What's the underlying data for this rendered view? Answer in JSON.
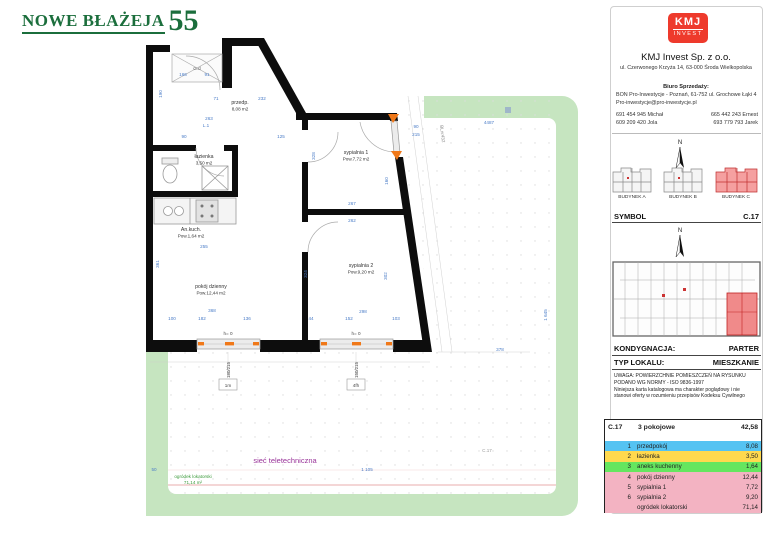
{
  "title": {
    "project": "NOWE BŁAŻEJA",
    "number": "55"
  },
  "company": {
    "logo_line1": "KMJ",
    "logo_line2": "INVEST",
    "name": "KMJ Invest Sp. z o.o.",
    "address": "ul. Czerwonego Krzyża 14, 63-000 Środa Wielkopolska",
    "sales_office_label": "Biuro Sprzedaży:",
    "sales_office_line1": "BON Pro-Inwestycje - Poznań, 61-752 ul. Grochowe Łąki 4",
    "sales_office_line2": "Pro-inwestycje@pro-inwestycje.pl",
    "phones_left": [
      "691 454 945 Michał",
      "609 209 420 Jola"
    ],
    "phones_right": [
      "665 442 243 Ernest",
      "693 779 793 Jarek"
    ]
  },
  "compass": "N",
  "buildings": [
    {
      "label": "BUDYNEK A",
      "highlighted": false
    },
    {
      "label": "BUDYNEK B",
      "highlighted": false
    },
    {
      "label": "BUDYNEK C",
      "highlighted": true
    }
  ],
  "symbol": {
    "label": "SYMBOL",
    "value": "C.17"
  },
  "floor": {
    "label": "KONDYGNACJA:",
    "value": "PARTER"
  },
  "unit_type": {
    "label": "TYP LOKALU:",
    "value": "MIESZKANIE"
  },
  "notice": {
    "lines": [
      "UWAGA: POWIERZCHNIE POMIESZCZEŃ NA RYSUNKU",
      "PODANO WG NORMY - ISO 9836-1997",
      "Niniejsza karta katalogowa ma charakter poglądowy i nie",
      "stanowi oferty w rozumieniu przepisów Kodeksu Cywilnego"
    ]
  },
  "table": {
    "symbol": "C.17",
    "type": "3 pokojowe",
    "total": "42,58",
    "rows": [
      {
        "num": "1",
        "name": "przedpokój",
        "area": "8,08",
        "color": "#55c3f2"
      },
      {
        "num": "2",
        "name": "łazienka",
        "area": "3,50",
        "color": "#ffd94e"
      },
      {
        "num": "3",
        "name": "aneks kuchenny",
        "area": "1,64",
        "color": "#65e65f"
      },
      {
        "num": "4",
        "name": "pokój dzienny",
        "area": "12,44",
        "color": "#f3b3c2"
      },
      {
        "num": "5",
        "name": "sypialnia 1",
        "area": "7,72",
        "color": "#f3b3c2"
      },
      {
        "num": "6",
        "name": "sypialnia 2",
        "area": "9,20",
        "color": "#f3b3c2"
      },
      {
        "num": "",
        "name": "ogródek lokatorski",
        "area": "71,14",
        "color": "#f3b3c2"
      }
    ]
  },
  "plan": {
    "rooms": [
      {
        "name": "przedp.",
        "area": "8,08 m2",
        "x": 240,
        "y": 104
      },
      {
        "name": "łazienka",
        "area": "3,50 m2",
        "x": 204,
        "y": 158
      },
      {
        "name": "An.kuch.",
        "area": "Pow.1,64 m2",
        "x": 191,
        "y": 231
      },
      {
        "name": "pokój dzienny",
        "area": "Pow.12,44 m2",
        "x": 211,
        "y": 288
      },
      {
        "name": "sypialnia 1",
        "area": "Pow.7,72 m2",
        "x": 356,
        "y": 154
      },
      {
        "name": "sypialnia 2",
        "area": "Pow.9,20 m2",
        "x": 361,
        "y": 267
      }
    ],
    "windows": [
      {
        "h": "h= 0",
        "size": "180/215",
        "tag": "1m",
        "cx": 228
      },
      {
        "h": "h= 0",
        "size": "150/215",
        "tag": "4fh",
        "cx": 356
      }
    ],
    "entrance": {
      "width": "90",
      "height": "215"
    },
    "garden": {
      "label": "ogródek lokatorski",
      "area": "71,14 m²",
      "network": "sieć teletechniczna",
      "plot_ref": "BLnr432",
      "unit_ref": "C.17"
    },
    "dims": [
      {
        "t": "166",
        "x": 183,
        "y": 76
      },
      {
        "t": "91",
        "x": 207,
        "y": 76
      },
      {
        "t": "190",
        "x": 162,
        "y": 94,
        "a": -90
      },
      {
        "t": "G.d",
        "x": 197,
        "y": 70,
        "c": "#666"
      },
      {
        "t": "71",
        "x": 216,
        "y": 100
      },
      {
        "t": "232",
        "x": 262,
        "y": 100
      },
      {
        "t": "263",
        "x": 209,
        "y": 120
      },
      {
        "t": "L.1",
        "x": 206,
        "y": 127
      },
      {
        "t": "90",
        "x": 184,
        "y": 138
      },
      {
        "t": "125",
        "x": 281,
        "y": 138
      },
      {
        "t": "328",
        "x": 315,
        "y": 156,
        "a": -90
      },
      {
        "t": "160",
        "x": 388,
        "y": 181,
        "a": -90
      },
      {
        "t": "267",
        "x": 352,
        "y": 205
      },
      {
        "t": "262",
        "x": 352,
        "y": 222
      },
      {
        "t": "255",
        "x": 204,
        "y": 248
      },
      {
        "t": "361",
        "x": 159,
        "y": 264,
        "a": -90
      },
      {
        "t": "324",
        "x": 307,
        "y": 274,
        "a": -90
      },
      {
        "t": "302",
        "x": 387,
        "y": 276,
        "a": -90
      },
      {
        "t": "368",
        "x": 212,
        "y": 312
      },
      {
        "t": "298",
        "x": 363,
        "y": 313
      },
      {
        "t": "100",
        "x": 172,
        "y": 320
      },
      {
        "t": "182",
        "x": 202,
        "y": 320
      },
      {
        "t": "136",
        "x": 247,
        "y": 320
      },
      {
        "t": "44",
        "x": 311,
        "y": 320
      },
      {
        "t": "152",
        "x": 349,
        "y": 320
      },
      {
        "t": "103",
        "x": 396,
        "y": 320
      },
      {
        "t": "90",
        "x": 416,
        "y": 128
      },
      {
        "t": "215",
        "x": 416,
        "y": 136
      },
      {
        "t": "4487",
        "x": 489,
        "y": 124
      },
      {
        "t": "BLnr432",
        "x": 441,
        "y": 134,
        "a": 83,
        "c": "#888"
      },
      {
        "t": "378",
        "x": 500,
        "y": 351
      },
      {
        "t": "1 645",
        "x": 547,
        "y": 315,
        "a": -90
      },
      {
        "t": "1 105",
        "x": 367,
        "y": 471
      },
      {
        "t": "50",
        "x": 154,
        "y": 471
      },
      {
        "t": "C.17",
        "x": 487,
        "y": 452,
        "c": "#999"
      }
    ]
  }
}
